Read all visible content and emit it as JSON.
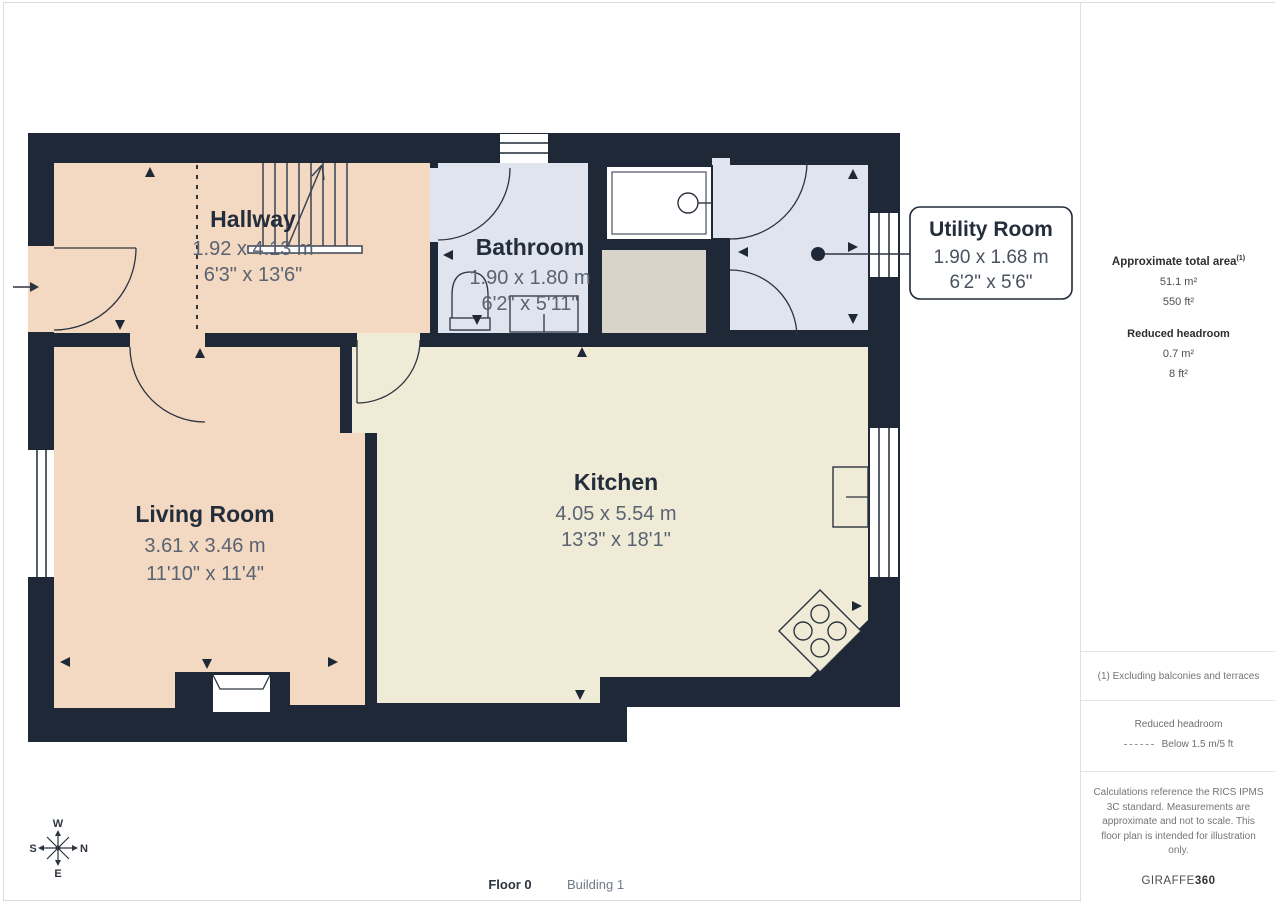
{
  "plan": {
    "rooms": {
      "hallway": {
        "name": "Hallway",
        "metric": "1.92 x 4.13 m",
        "imperial": "6'3\" x 13'6\""
      },
      "bathroom": {
        "name": "Bathroom",
        "metric": "1.90 x 1.80 m",
        "imperial": "6'2\" x 5'11\""
      },
      "utility": {
        "name": "Utility Room",
        "metric": "1.90 x 1.68 m",
        "imperial": "6'2\" x 5'6\""
      },
      "living": {
        "name": "Living Room",
        "metric": "3.61 x 3.46 m",
        "imperial": "11'10\" x 11'4\""
      },
      "kitchen": {
        "name": "Kitchen",
        "metric": "4.05 x 5.54 m",
        "imperial": "13'3\" x 18'1\""
      }
    },
    "compass": {
      "n": "N",
      "s": "S",
      "e": "E",
      "w": "W"
    }
  },
  "sidebar": {
    "total_area": {
      "title": "Approximate total area",
      "sup": "(1)",
      "m2": "51.1 m²",
      "ft2": "550 ft²"
    },
    "reduced_headroom": {
      "title": "Reduced headroom",
      "m2": "0.7 m²",
      "ft2": "8 ft²"
    },
    "footnote": "(1) Excluding balconies and terraces",
    "legend": {
      "title": "Reduced headroom",
      "label": "Below 1.5 m/5 ft"
    },
    "disclaimer": "Calculations reference the RICS IPMS 3C standard. Measurements are approximate and not to scale. This floor plan is intended for illustration only.",
    "brand": {
      "name": "GIRAFFE",
      "bold": "360"
    }
  },
  "footer": {
    "floor": "Floor 0",
    "building": "Building 1"
  },
  "colors": {
    "wall": "#1e2837",
    "hallway_floor": "#f3d8c2",
    "bathroom_floor": "#e0e4ee",
    "kitchen_floor": "#f0ebd7",
    "cupboard": "#d8d4c9",
    "dim_text": "#5a6372"
  }
}
